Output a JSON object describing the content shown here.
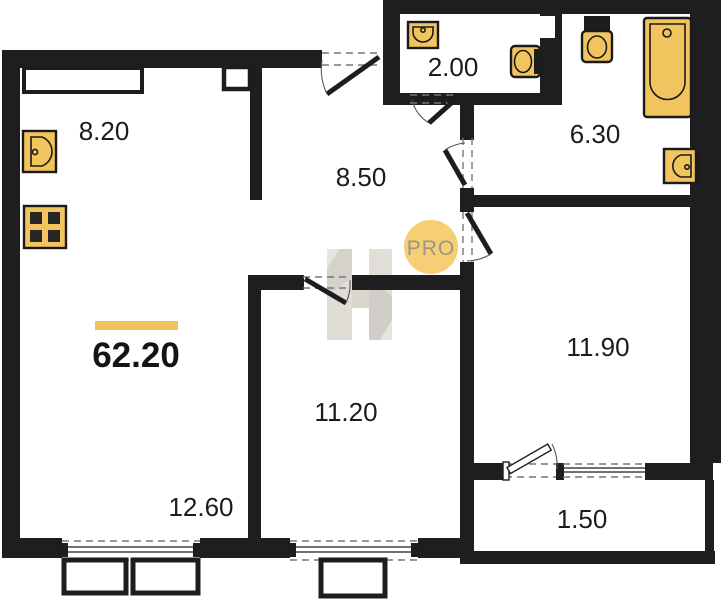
{
  "plan": {
    "title": "apartment-floor-plan",
    "total": {
      "area": "62.20"
    },
    "watermark": {
      "badge": "PRO"
    },
    "rooms": [
      {
        "name": "kitchen",
        "area": "8.20"
      },
      {
        "name": "wc",
        "area": "2.00"
      },
      {
        "name": "bathroom",
        "area": "6.30"
      },
      {
        "name": "hallway",
        "area": "8.50"
      },
      {
        "name": "bedroom",
        "area": "11.90"
      },
      {
        "name": "room",
        "area": "11.20"
      },
      {
        "name": "living-room",
        "area": "12.60"
      },
      {
        "name": "balcony",
        "area": "1.50"
      }
    ],
    "colors": {
      "wall": "#1e1e21",
      "fixture": "#f2c45e",
      "accent_bar": "#edc55f",
      "badge_bg": "#f6ce74"
    }
  }
}
